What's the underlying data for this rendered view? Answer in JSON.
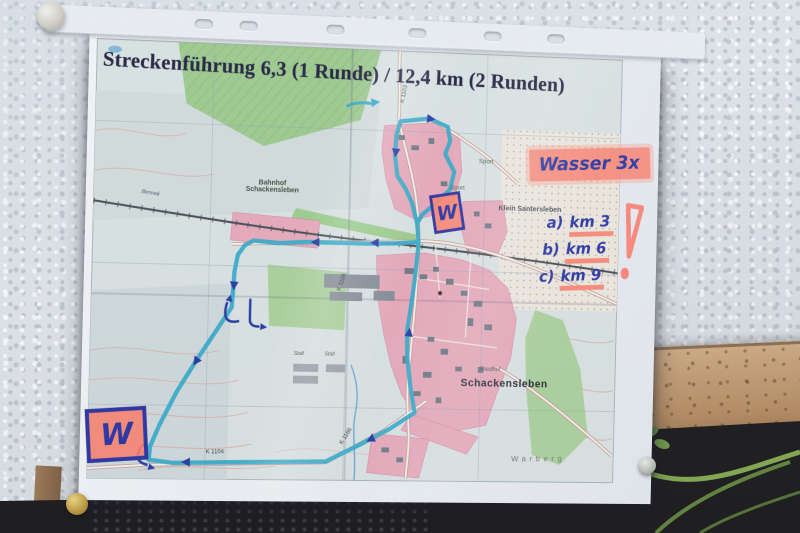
{
  "poster": {
    "title": "Streckenführung 6,3 (1 Runde) / 12,4 km (2 Runden)",
    "handwritten": {
      "water_note": "Wasser 3x",
      "water_points": [
        {
          "letter": "a)",
          "km": "km 3"
        },
        {
          "letter": "b)",
          "km": "km 6"
        },
        {
          "letter": "c)",
          "km": "km 9"
        }
      ],
      "w_marker_north": "W",
      "w_marker_southwest": "W"
    },
    "map": {
      "labels": {
        "station_line1": "Bahnhof",
        "station_line2": "Schackensleben",
        "village": "Klein Santersleben",
        "town": "Schackensleben",
        "cemetery": "Friedhof",
        "sport_north": "Sport",
        "sport_pool": "Sport",
        "stall_1": "Stall",
        "stall_2": "Stall",
        "hill": "Warberg",
        "stream": "Bennek"
      },
      "roads": {
        "k1104": "K 1104",
        "k1166_sw": "K 1166",
        "k1166_mid": "K 1166",
        "k1103_top": "K 1103"
      }
    },
    "colors": {
      "route_marker": "#2fa9c9",
      "pen_blue": "#2833a2",
      "highlighter_pink": "#ff8576",
      "title_ink": "#1a1a38",
      "urban_pink": "#eaa9ba",
      "field_green": "#a5d08f"
    }
  }
}
